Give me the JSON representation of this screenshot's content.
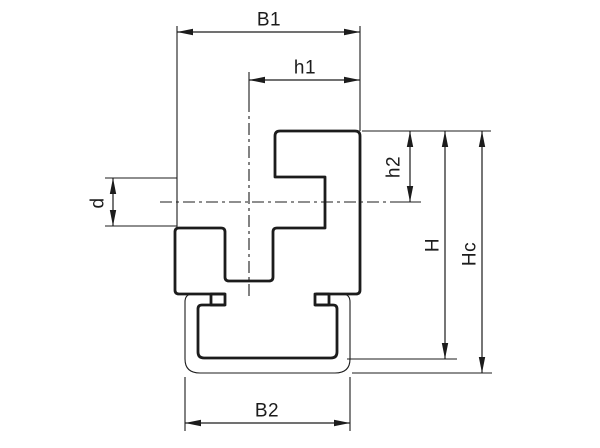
{
  "drawing": {
    "description": "Technical cross-section drawing of a chain guide profile clipped onto a C-rail, with dimension annotations",
    "colors": {
      "ink": "#1c1c1c",
      "background": "#ffffff"
    },
    "labels": {
      "b1": "B1",
      "h1": "h1",
      "h2": "h2",
      "d": "d",
      "h": "H",
      "hc": "Hc",
      "b2": "B2"
    }
  }
}
